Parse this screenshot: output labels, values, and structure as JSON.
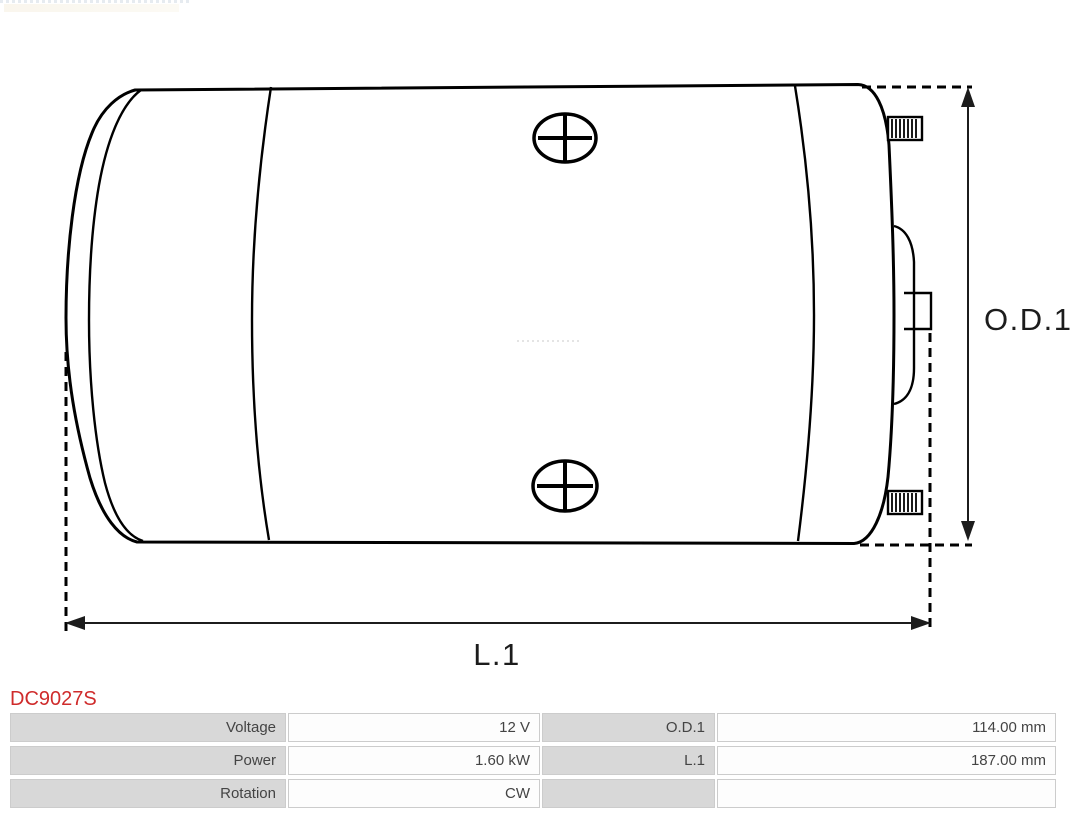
{
  "title": {
    "part_code": "DC9027S"
  },
  "drawing": {
    "type": "technical-drawing-side-view-dc-motor",
    "dimension_labels": [
      {
        "id": "od1",
        "text": "O.D.1"
      },
      {
        "id": "l1",
        "text": "L.1"
      }
    ]
  },
  "colors": {
    "accent_red": "#cf2b2b",
    "drawing_line": "#000000",
    "dimension_line": "#1c1c1c",
    "table_label_bg": "#d8d8d8",
    "table_value_bg": "#fdfdfd",
    "table_border": "#cccccc",
    "table_text": "#444444"
  },
  "spec_table": {
    "rows": [
      {
        "label1": "Voltage",
        "value1": "12 V",
        "label2": "O.D.1",
        "value2": "114.00 mm"
      },
      {
        "label1": "Power",
        "value1": "1.60 kW",
        "label2": "L.1",
        "value2": "187.00 mm"
      },
      {
        "label1": "Rotation",
        "value1": "CW",
        "label2": "",
        "value2": ""
      }
    ]
  }
}
